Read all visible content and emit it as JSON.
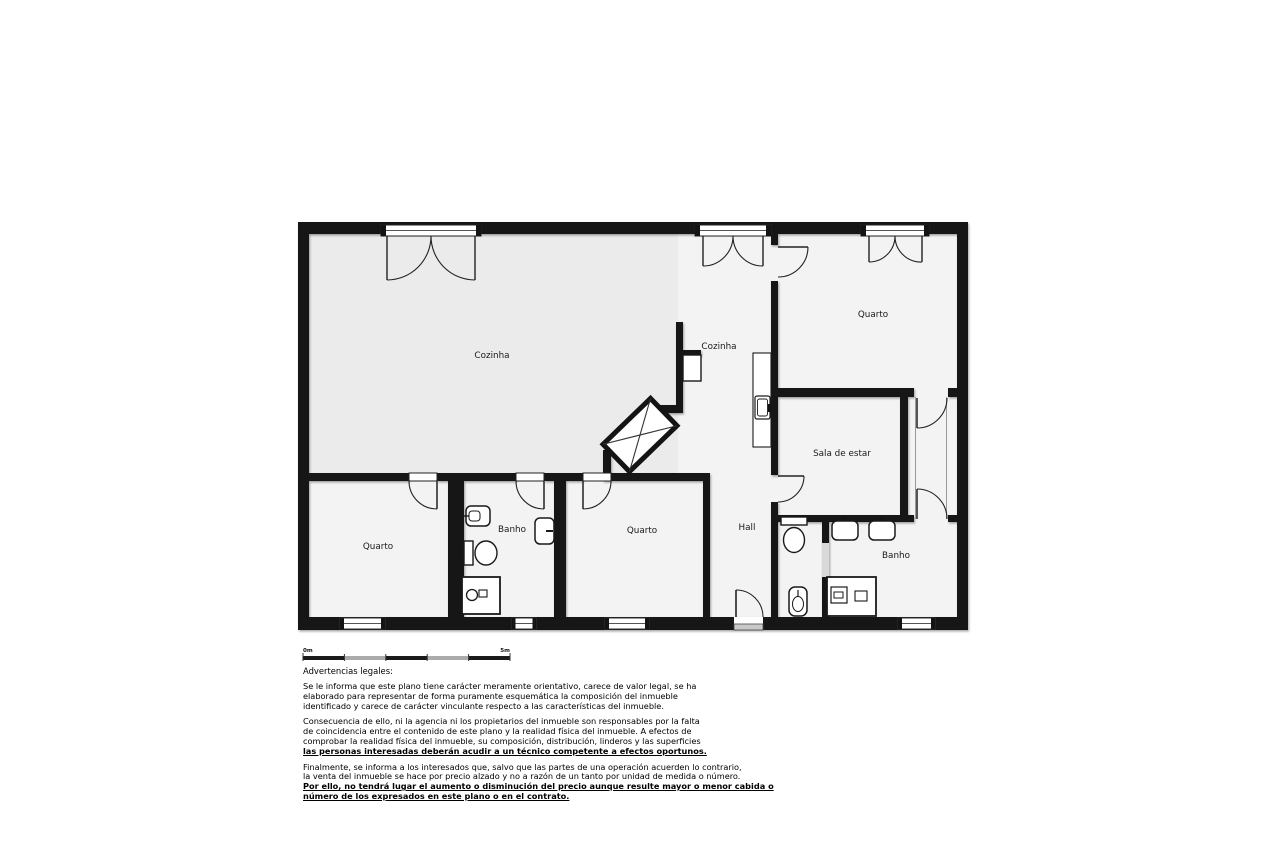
{
  "plan": {
    "labels": {
      "cozinha_main": "Cozinha",
      "cozinha_small": "Cozinha",
      "quarto_top_right": "Quarto",
      "sala_de_estar": "Sala de estar",
      "quarto_bottom_left": "Quarto",
      "banho_left": "Banho",
      "quarto_bottom_middle": "Quarto",
      "hall": "Hall",
      "banho_right": "Banho"
    },
    "colors": {
      "wall": "#141414",
      "room_fill": "#f3f3f3",
      "room_fill_dark": "#ebebeb",
      "scale_dark": "#1a1a1a",
      "scale_light": "#ababab"
    }
  },
  "scale_bar": {
    "start_label": "0m",
    "end_label": "5m"
  },
  "legal": {
    "title": "Advertencias legales:",
    "p1_lines": [
      "Se le informa que este plano tiene carácter meramente orientativo, carece de valor legal, se ha",
      "elaborado para representar de forma puramente esquemática la composición del inmueble",
      "identificado y carece de carácter vinculante respecto a las características del inmueble."
    ],
    "p2_lines": [
      "Consecuencia de ello, ni la agencia ni los propietarios del inmueble son responsables por la falta",
      "de coincidencia entre el contenido de este plano y la realidad física del inmueble. A efectos de",
      "comprobar la realidad física del inmueble, su composición, distribución, linderos y las superficies"
    ],
    "p2_emphasis": "las personas interesadas deberán acudir a un técnico competente a efectos oportunos.",
    "p3_lines": [
      "Finalmente, se informa a los interesados que, salvo que las partes de una operación acuerden lo contrario,",
      "la venta del inmueble se hace por precio alzado y no a razón de un tanto por unidad de medida o número."
    ],
    "p3_emphasis_lines": [
      "Por ello, no tendrá lugar el aumento o disminución del precio aunque resulte mayor o menor cabida o",
      "número de los expresados en este plano o en el contrato."
    ]
  }
}
